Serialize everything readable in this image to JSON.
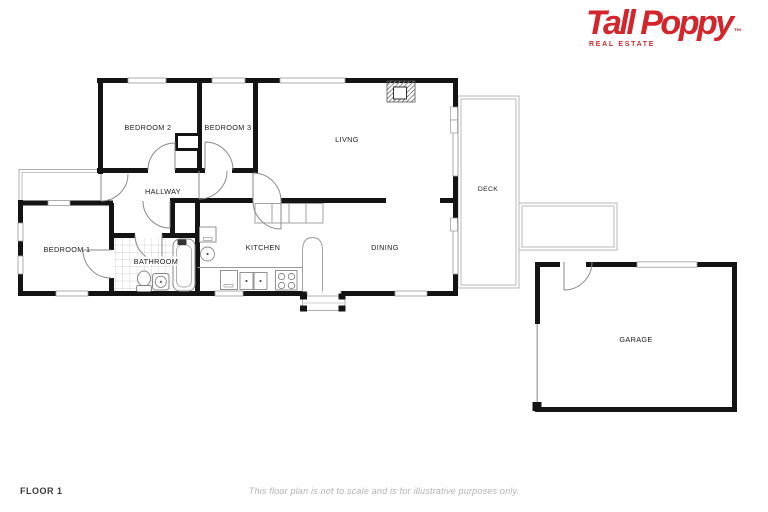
{
  "header": {
    "logo_title": "Tall Poppy",
    "logo_tm": "™",
    "logo_subtitle": "REAL ESTATE",
    "logo_color": "#d2262c"
  },
  "plan": {
    "wall_color": "#141414",
    "thin_line_color": "#999999",
    "deck_line_color": "#b8b8b8",
    "rooms": [
      {
        "id": "bedroom2",
        "label": "BEDROOM 2"
      },
      {
        "id": "bedroom3",
        "label": "BEDROOM 3"
      },
      {
        "id": "living",
        "label": "LIVNG"
      },
      {
        "id": "hallway",
        "label": "HALLWAY"
      },
      {
        "id": "bedroom1",
        "label": "BEDROOM 1"
      },
      {
        "id": "bathroom",
        "label": "BATHROOM"
      },
      {
        "id": "kitchen",
        "label": "KITCHEN"
      },
      {
        "id": "dining",
        "label": "DINING"
      },
      {
        "id": "deck",
        "label": "DECK"
      },
      {
        "id": "garage",
        "label": "GARAGE"
      }
    ]
  },
  "footer": {
    "floor_label": "FLOOR 1",
    "disclaimer": "This floor plan is not to scale and is for illustrative purposes only."
  }
}
